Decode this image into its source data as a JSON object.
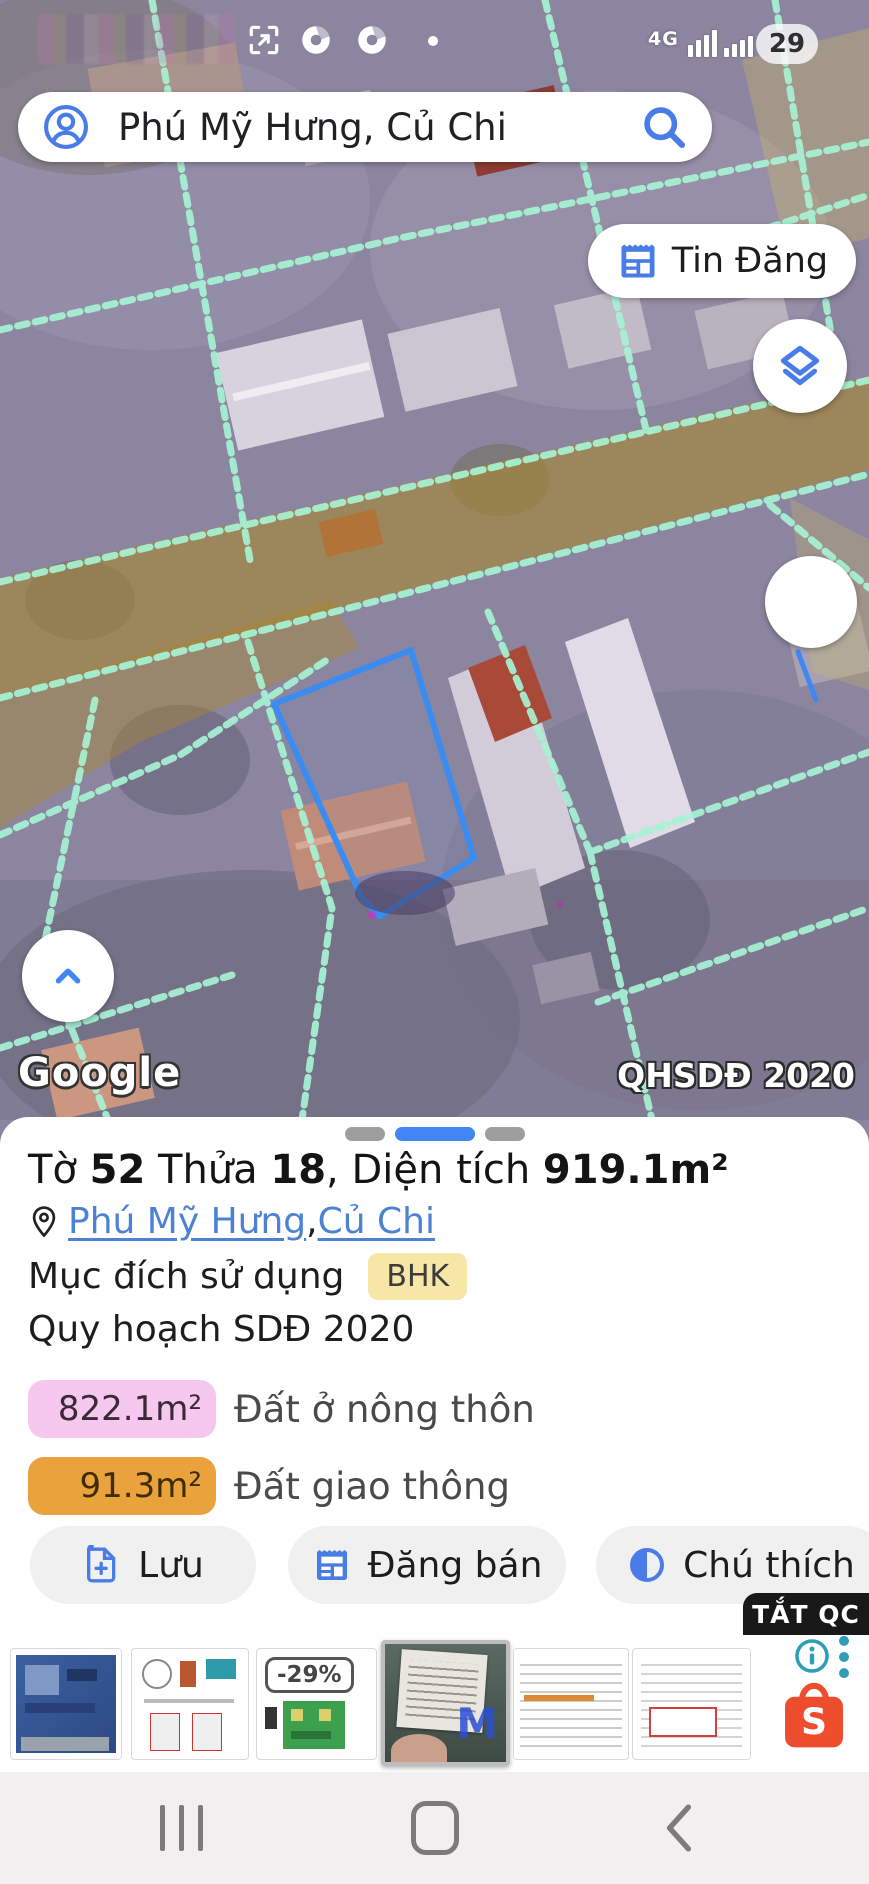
{
  "status_bar": {
    "network_type": "4G",
    "battery_level": "29"
  },
  "search_bar": {
    "query": "Phú Mỹ Hưng, Củ Chi"
  },
  "map": {
    "posts_button_label": "Tin Đăng",
    "watermark": "Google",
    "layer_badge": "QHSDĐ 2020"
  },
  "parcel_panel": {
    "title": {
      "prefix": "Tờ ",
      "sheet_no": "52",
      "mid": " Thửa ",
      "parcel_no": "18",
      "area_label": ", Diện tích ",
      "area_value": "919.1m²"
    },
    "location": {
      "ward": "Phú Mỹ Hưng",
      "separator": ", ",
      "district": "Củ Chi"
    },
    "purpose": {
      "label": "Mục đích sử dụng",
      "code": "BHK"
    },
    "planning_label": "Quy hoạch SDĐ 2020",
    "land_uses": [
      {
        "area": "822.1m²",
        "label": "Đất ở nông thôn",
        "color": "#f7c8ef"
      },
      {
        "area": "91.3m²",
        "label": "Đất giao thông",
        "color": "#e9a23c"
      }
    ],
    "actions": {
      "save": "Lưu",
      "sell": "Đăng bán",
      "legend": "Chú thích"
    }
  },
  "ad": {
    "dismiss_label": "TẮT QC",
    "discount_badge": "-29%"
  },
  "colors": {
    "accent_blue": "#4285f4",
    "parcel_outline": "#3b8cf0",
    "cadastral_line": "#a7f3d4",
    "road_overlay": "#a8872e",
    "bhk_badge": "#f6e7a6",
    "residential_badge": "#f7c8ef",
    "traffic_badge": "#e9a23c",
    "shopee_orange": "#ee4d2d",
    "ad_info_teal": "#2d9db8"
  }
}
